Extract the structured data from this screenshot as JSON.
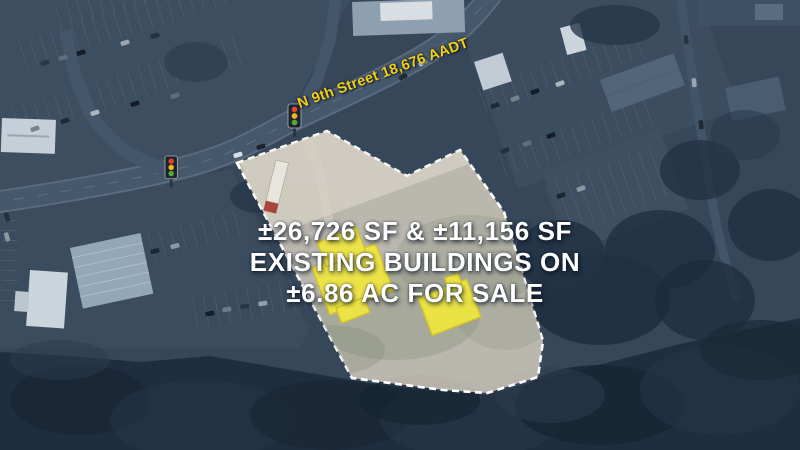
{
  "street_label": {
    "text": "N 9th Street 18,676 AADT",
    "color": "#f3cf16"
  },
  "headline": {
    "lines": [
      "±26,726 SF & ±11,156 SF",
      "EXISTING BUILDINGS ON",
      "±6.86 AC FOR SALE"
    ],
    "color": "#ffffff"
  },
  "parcel": {
    "fill_color": "#d7cfc1",
    "outline_color": "#ffffff",
    "outline_style": "dashed"
  },
  "highlighted_buildings": {
    "count": 2,
    "fill_color": "#f2e93d",
    "outline_color": "#d9ca14"
  },
  "traffic_light": {
    "red": "#e0442f",
    "amber": "#f0b429",
    "green": "#55a83a"
  }
}
